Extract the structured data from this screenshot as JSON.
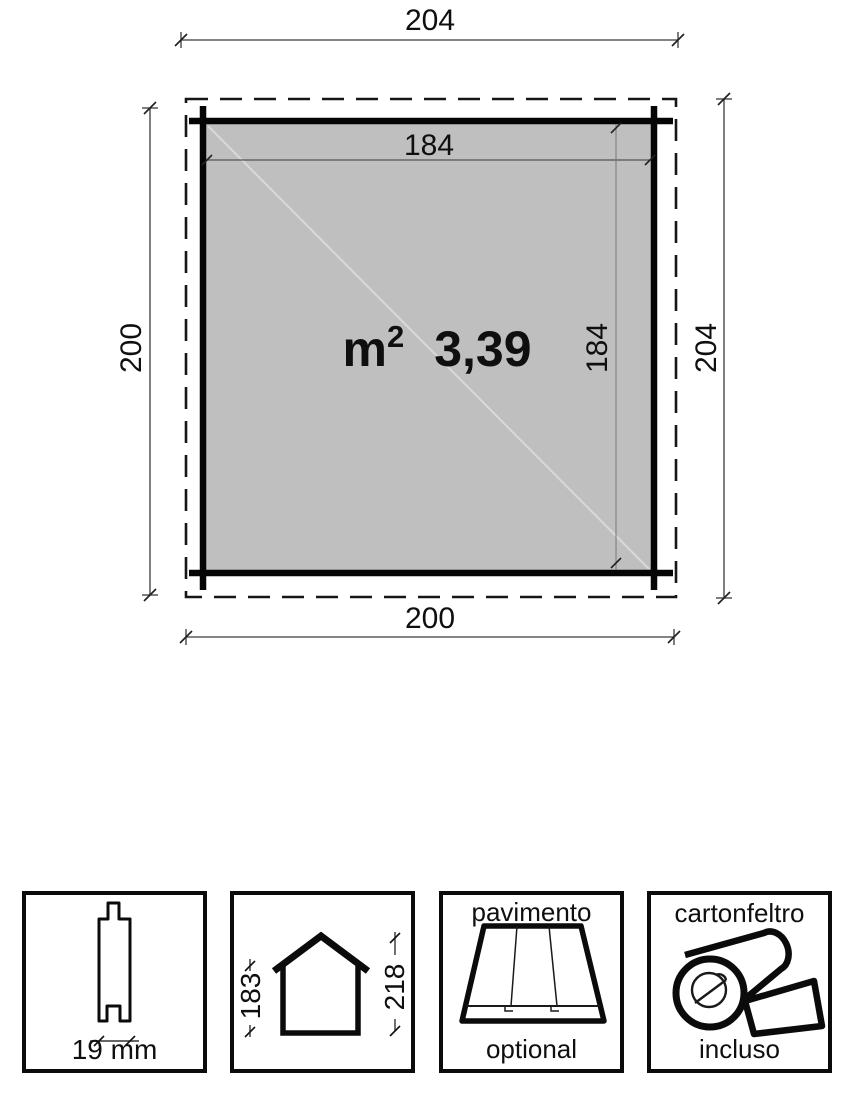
{
  "diagram": {
    "plan": {
      "top_width": "204",
      "left_depth": "200",
      "right_depth": "204",
      "bottom_width": "200",
      "inner_width": "184",
      "inner_depth": "184",
      "area_unit": "m",
      "area_exponent": "2",
      "area_value": "3,39"
    },
    "legend": {
      "plank": {
        "dimension": "19 mm"
      },
      "house": {
        "wall_height": "183",
        "ridge_height": "218"
      },
      "floor": {
        "name": "pavimento",
        "availability": "optional"
      },
      "felt": {
        "name": "cartonfeltro",
        "availability": "incluso"
      }
    },
    "colors": {
      "floor_fill": "#bfbfbf",
      "line": "#111111"
    }
  }
}
